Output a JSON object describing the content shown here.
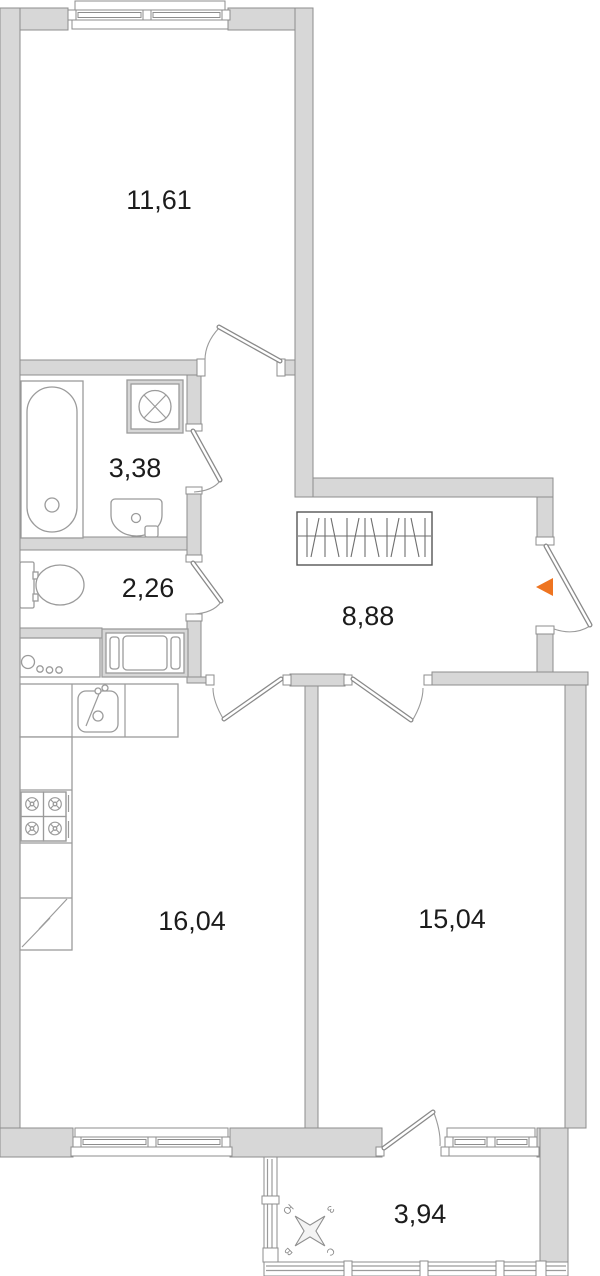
{
  "floorplan": {
    "rooms": [
      {
        "area": "11,61"
      },
      {
        "area": "3,38"
      },
      {
        "area": "2,26"
      },
      {
        "area": "8,88"
      },
      {
        "area": "16,04"
      },
      {
        "area": "15,04"
      },
      {
        "area": "3,94"
      }
    ],
    "compass": {
      "n": "С",
      "s": "Ю",
      "e": "В",
      "w": "З"
    },
    "colors": {
      "wall_fill": "#d7d7d7",
      "wall_stroke": "#8d8d8d",
      "fixture_stroke": "#9b9b9b",
      "label_text": "#1c1c1c",
      "entrance_marker": "#ee7420",
      "background": "#ffffff"
    }
  }
}
